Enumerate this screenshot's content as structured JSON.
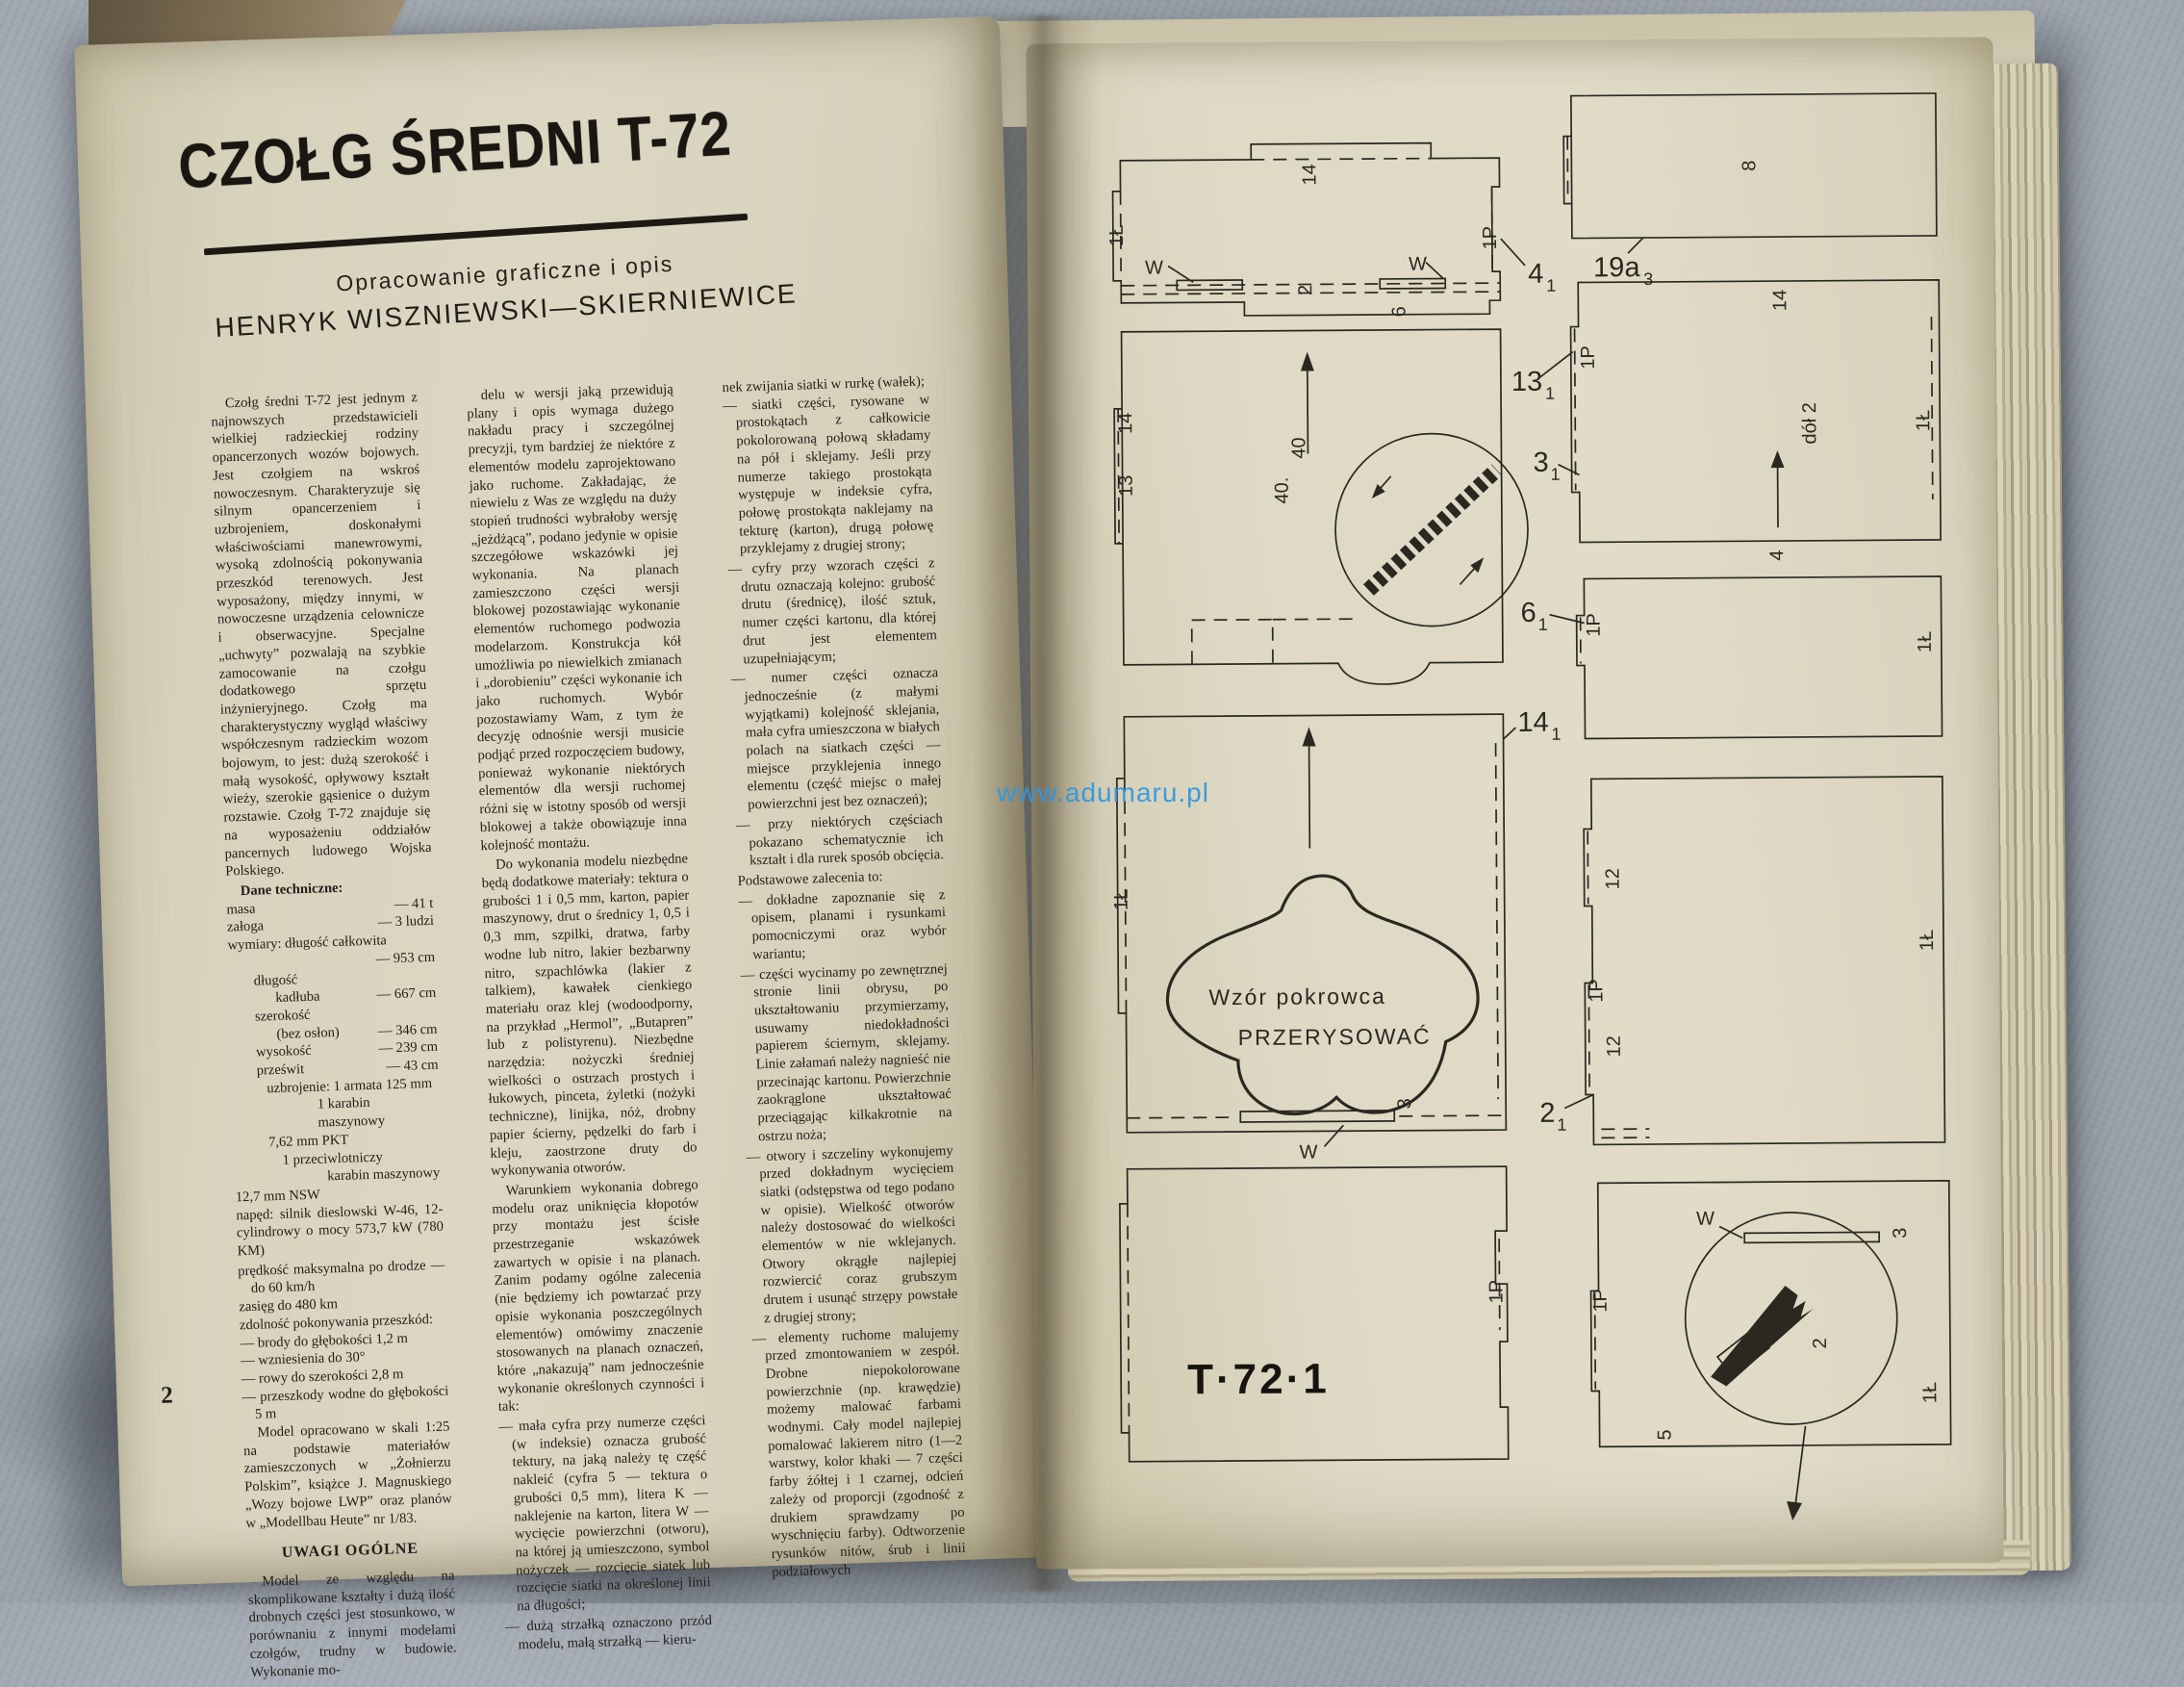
{
  "photo": {
    "watermark": "www.adumaru.pl"
  },
  "left_page": {
    "page_number": "2",
    "title": "CZOŁG ŚREDNI T-72",
    "byline_line1": "Opracowanie graficzne i opis",
    "byline_line2": "HENRYK WISZNIEWSKI—SKIERNIEWICE",
    "col1": {
      "intro": "Czołg średni T-72 jest jednym z najnowszych przedstawicieli wielkiej radzieckiej rodziny opancerzonych wozów bojowych. Jest czołgiem na wskroś nowoczesnym. Charakteryzuje się silnym opancerzeniem i uzbrojeniem, doskonałymi właściwościami manewrowymi, wysoką zdolnością pokonywania przeszkód terenowych. Jest wyposażony, między innymi, w nowoczesne urządzenia celownicze i obserwacyjne. Specjalne „uchwyty” pozwalają na szybkie zamocowanie na czołgu dodatkowego sprzętu inżynieryjnego. Czołg ma charakterystyczny wygląd właściwy współczesnym radzieckim wozom bojowym, to jest: dużą szerokość i małą wysokość, opływowy kształt wieży, szerokie gąsienice o dużym rozstawie. Czołg T-72 znajduje się na wyposażeniu oddziałów pancernych ludowego Wojska Polskiego.",
      "specs_heading": "Dane techniczne:",
      "specs": [
        {
          "label": "masa",
          "value": "— 41 t"
        },
        {
          "label": "załoga",
          "value": "— 3 ludzi"
        },
        {
          "label": "wymiary: długość całkowita",
          "value": ""
        },
        {
          "label": "",
          "value": "— 953 cm"
        },
        {
          "label": "długość",
          "value": ""
        },
        {
          "label": "kadłuba",
          "value": "— 667 cm"
        },
        {
          "label": "szerokość",
          "value": ""
        },
        {
          "label": "(bez osłon)",
          "value": "— 346 cm"
        },
        {
          "label": "wysokość",
          "value": "— 239 cm"
        },
        {
          "label": "prześwit",
          "value": "— 43 cm"
        }
      ],
      "armament_lines": [
        "uzbrojenie: 1 armata 125 mm",
        "1 karabin maszynowy",
        "7,62 mm PKT",
        "1 przeciwlotniczy",
        "karabin maszynowy",
        "12,7 mm NSW"
      ],
      "drive_note": "napęd: silnik dieslowski W-46, 12-cylindrowy o mocy 573,7 kW (780 KM)",
      "performance_lines": [
        "prędkość maksymalna po drodze — do 60 km/h",
        "zasięg do 480 km",
        "zdolność pokonywania przeszkód:",
        "— brody do głębokości 1,2 m",
        "— wzniesienia do 30°",
        "— rowy do szerokości 2,8 m",
        "— przeszkody wodne do głębokości 5 m"
      ],
      "model_note": "Model opracowano w skali 1:25 na podstawie materiałów zamieszczonych w „Żołnierzu Polskim”, książce J. Magnuskiego „Wozy bojowe LWP” oraz planów w „Modellbau Heute” nr 1/83.",
      "remarks_heading": "UWAGI OGÓLNE",
      "remarks_para": "Model ze względu na skomplikowane kształty i dużą ilość drobnych części jest stosunkowo, w porównaniu z innymi modelami czołgów, trudny w budowie. Wykonanie mo-"
    },
    "col2": {
      "paragraphs": [
        "delu w wersji jaką przewidują plany i opis wymaga dużego nakładu pracy i szczególnej precyzji, tym bardziej że niektóre z elementów modelu zaprojektowano jako ruchome. Zakładając, że niewielu z Was ze względu na duży stopień trudności wybrałoby wersję „jeżdżącą”, podano jedynie w opisie szczegółowe wskazówki jej wykonania. Na planach zamieszczono części wersji blokowej pozostawiając wykonanie elementów ruchomego podwozia modelarzom. Konstrukcja kół umożliwia po niewielkich zmianach i „dorobieniu” części wykonanie ich jako ruchomych. Wybór pozostawiamy Wam, z tym że decyzję odnośnie wersji musicie podjąć przed rozpoczęciem budowy, ponieważ wykonanie niektórych elementów dla wersji ruchomej różni się w istotny sposób od wersji blokowej a także obowiązuje inna kolejność montażu.",
        "Do wykonania modelu niezbędne będą dodatkowe materiały: tektura o grubości 1 i 0,5 mm, karton, papier maszynowy, drut o średnicy 1, 0,5 i 0,3 mm, szpilki, dratwa, farby wodne lub nitro, lakier bezbarwny nitro, szpachlówka (lakier z talkiem), kawałek cienkiego materiału oraz klej (wodoodporny, na przykład „Hermol”, „Butapren” lub z polistyrenu). Niezbędne narzędzia: nożyczki średniej wielkości o ostrzach prostych i łukowych, pinceta, żyletki (nożyki techniczne), linijka, nóż, drobny papier ścierny, pędzelki do farb i kleju, zaostrzone druty do wykonywania otworów.",
        "Warunkiem wykonania dobrego modelu oraz uniknięcia kłopotów przy montażu jest ścisłe przestrzeganie wskazówek zawartych w opisie i na planach. Zanim podamy ogólne zalecenia (nie będziemy ich powtarzać przy opisie wykonania poszczególnych elementów) omówimy znaczenie stosowanych na planach oznaczeń, które „nakazują” nam jednocześnie wykonanie określonych czynności i tak:"
      ],
      "bullets": [
        "— mała cyfra przy numerze części (w indeksie) oznacza grubość tektury, na jaką należy tę część nakleić (cyfra 5 — tektura o grubości 0,5 mm), litera K — naklejenie na karton, litera W — wycięcie powierzchni (otworu), na której ją umieszczono, symbol nożyczek — rozcięcie siatek lub rozcięcie siatki na określonej linii na długości;",
        "— dużą strzałką oznaczono przód modelu, małą strzałką — kieru-"
      ]
    },
    "col3": {
      "lead_line": "nek zwijania siatki w rurkę (wałek);",
      "bullets_a": [
        "— siatki części, rysowane w prostokątach z całkowicie pokolorowaną połową składamy na pół i sklejamy. Jeśli przy numerze takiego prostokąta występuje w indeksie cyfra, połowę prostokąta naklejamy na tekturę (karton), drugą połowę przyklejamy z drugiej strony;",
        "— cyfry przy wzorach części z drutu oznaczają kolejno: grubość drutu (średnicę), ilość sztuk, numer części kartonu, dla której drut jest elementem uzupełniającym;",
        "— numer części oznacza jednocześnie (z małymi wyjątkami) kolejność sklejania, mała cyfra umieszczona w białych polach na siatkach części — miejsce przyklejenia innego elementu (część miejsc o małej powierzchni jest bez oznaczeń);",
        "— przy niektórych częściach pokazano schematycznie ich kształt i dla rurek sposób obcięcia."
      ],
      "recommendations_intro": "Podstawowe zalecenia to:",
      "bullets_b": [
        "— dokładne zapoznanie się z opisem, planami i rysunkami pomocniczymi oraz wybór wariantu;",
        "— części wycinamy po zewnętrznej stronie linii obrysu, po ukształtowaniu przymierzamy, usuwamy niedokładności papierem ściernym, sklejamy. Linie załamań należy nagnieść nie przecinając kartonu. Powierzchnie zaokrąglone ukształtować przeciągając kilkakrotnie na ostrzu noża;",
        "— otwory i szczeliny wykonujemy przed dokładnym wycięciem siatki (odstępstwa od tego podano w opisie). Wielkość otworów należy dostosować do wielkości elementów w nie wklejanych. Otwory okrągłe najlepiej rozwiercić coraz grubszym drutem i usunąć strzępy powstałe z drugiej strony;",
        "— elementy ruchome malujemy przed zmontowaniem w zespół. Drobne niepokolorowane powierzchnie (np. krawędzie) możemy malować farbami wodnymi. Cały model najlepiej pomalować lakierem nitro (1—2 warstwy, kolor khaki — 7 części farby żółtej i 1 czarnej, odcień zależy od proporcji (zgodność z drukiem sprawdzamy po wyschnięciu farby). Odtworzenie rysunków nitów, śrub i linii podziałowych"
      ]
    }
  },
  "right_page": {
    "sheet_code": "T·72·1",
    "cover_pattern_line1": "Wzór pokrowca",
    "cover_pattern_line2": "PRZERYSOWAĆ",
    "labels": {
      "n14": "14",
      "n1L": "1Ł",
      "n1P": "1P",
      "w": "W",
      "n2": "2",
      "n6": "6",
      "n8": "8",
      "n13": "13",
      "n40": "40",
      "n40d": "40.",
      "n12": "12",
      "n4": "4",
      "n3": "3",
      "n5": "5",
      "dol2": "dół 2"
    },
    "callouts": [
      {
        "main": "4",
        "sub": "1"
      },
      {
        "main": "19a",
        "sub": "3"
      },
      {
        "main": "13",
        "sub": "1"
      },
      {
        "main": "3",
        "sub": "1"
      },
      {
        "main": "6",
        "sub": "1"
      },
      {
        "main": "14",
        "sub": "1"
      },
      {
        "main": "2",
        "sub": "1"
      }
    ]
  }
}
